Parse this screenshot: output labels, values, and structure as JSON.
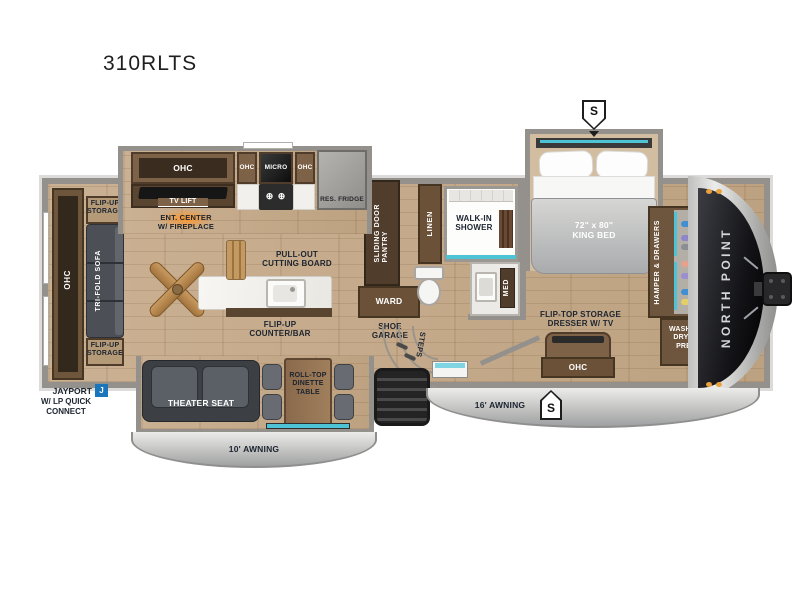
{
  "title": "310RLTS",
  "slide_marker": "S",
  "colors": {
    "accent_teal": "#4fc3d6",
    "jayport_blue": "#1b75bb",
    "label_dark": "#1c2430",
    "wood_floor": "#c6ac8e",
    "cabinet_brown": "#7d6247",
    "wall_gray": "#94918d"
  },
  "rear": {
    "ohc": "OHC",
    "flip_up_storage_top": "FLIP-UP\nSTORAGE",
    "tri_fold_sofa": "TRI-FOLD SOFA",
    "flip_up_storage_bottom": "FLIP-UP\nSTORAGE",
    "jayport": "JAYPORT",
    "jayport_badge": "J",
    "jayport_sub": "W/ LP QUICK\nCONNECT"
  },
  "kitchen": {
    "ohc_long": "OHC",
    "ohc_left": "OHC",
    "micro": "MICRO",
    "ohc_right": "OHC",
    "res_fridge": "RES. FRIDGE",
    "burners": "⊕ ⊕",
    "tv_lift": "TV LIFT",
    "ent_center": "ENT. CENTER\nW/ FIREPLACE",
    "pull_out_cutting_board": "PULL-OUT\nCUTTING BOARD",
    "flip_up_counter_bar": "FLIP-UP\nCOUNTER/BAR"
  },
  "living": {
    "theater_seat": "THEATER SEAT",
    "dinette_table": "ROLL-TOP\nDINETTE\nTABLE",
    "awning_10": "10' AWNING"
  },
  "bath": {
    "sliding_door_pantry": "SLIDING DOOR\nPANTRY",
    "ward": "WARD",
    "linen": "LINEN",
    "walk_in_shower": "WALK-IN\nSHOWER",
    "med": "MED",
    "shoe_garage": "SHOE\nGARAGE",
    "steps": "STEPS"
  },
  "bedroom": {
    "king_bed": "72\" x 80\"\nKING BED",
    "hamper_drawers": "HAMPER & DRAWERS",
    "washer_dryer_prep": "WASHER/\nDRYER\nPREP",
    "flip_top_dresser": "FLIP-TOP STORAGE\nDRESSER W/ TV",
    "ohc_dresser": "OHC",
    "awning_16": "16' AWNING"
  },
  "front_cap": {
    "brand": "NORTH POINT"
  }
}
